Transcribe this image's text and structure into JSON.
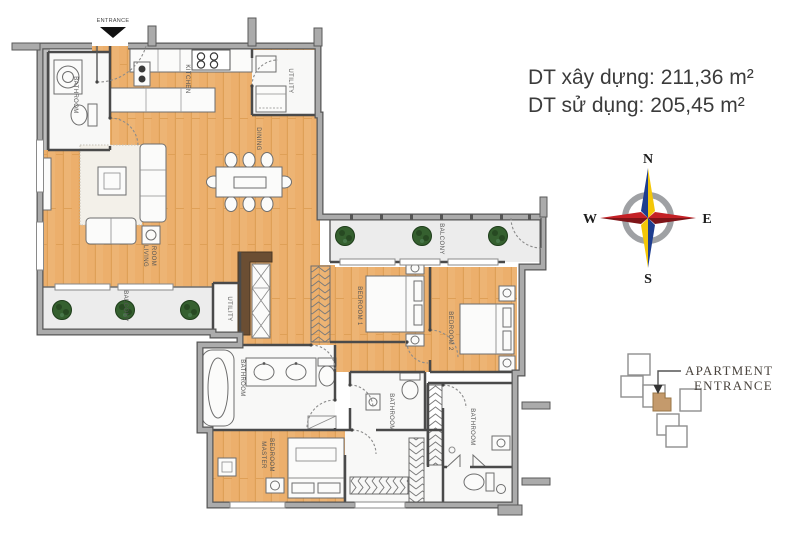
{
  "title": {
    "built_area": "DT xây dựng: 211,36 m²",
    "usable_area": "DT sử dụng: 205,45 m²"
  },
  "compass": {
    "north": "N",
    "east": "E",
    "south": "S",
    "west": "W"
  },
  "legend": {
    "line1": "APARTMENT",
    "line2": "ENTRANCE"
  },
  "plan": {
    "labels": {
      "entrance": "ENTRANCE",
      "bathroom_entry": "BATHROOM",
      "kitchen": "KITCHEN",
      "utility_kitchen": "UTILITY",
      "dining": "DINING",
      "living_line1": "LIVING",
      "living_line2": "ROOM",
      "balcony_left": "BALCONY",
      "utility_hall": "UTILITY",
      "balcony_right": "BALCONY",
      "bedroom1": "BEDROOM 1",
      "bedroom2": "BEDROOM 2",
      "bathroom_master": "BATHROOM",
      "master_line1": "MASTER",
      "master_line2": "BEDROOM",
      "bathroom_mid": "BATHROOM",
      "bathroom_right": "BATHROOM"
    }
  },
  "colors": {
    "wood": "#ECAF6C",
    "wood_line": "#DFA057",
    "wall": "#A8A8A8",
    "wall_dark": "#4A4A4A",
    "white_room": "#F8F8F7",
    "balcony": "#ECECEC",
    "brown_band": "#6B4E33",
    "plant_green": "#35602F",
    "key_unit_tan": "#C49A6C",
    "compass_red": "#C42126",
    "compass_blue": "#1E3D8F",
    "compass_yellow": "#F4C708",
    "text": "#3B3B3B"
  }
}
